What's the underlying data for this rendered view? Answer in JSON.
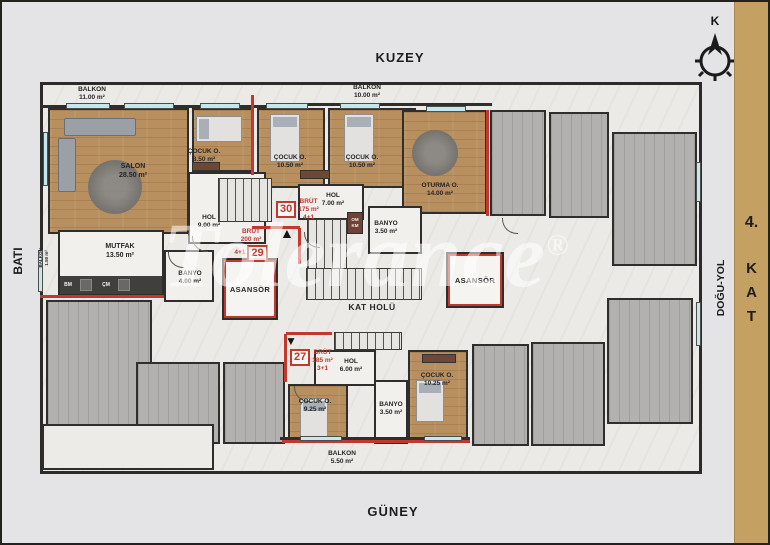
{
  "directions": {
    "north": "KUZEY",
    "south": "GÜNEY",
    "west": "BATI",
    "east": "DOĞU-YOL"
  },
  "compass": {
    "label": "K"
  },
  "floor": {
    "number": "4.",
    "letters": [
      "K",
      "A",
      "T"
    ]
  },
  "watermark": {
    "text": "Tolerance",
    "reg": "®"
  },
  "units": [
    {
      "number": "30",
      "brut": "BRÜT",
      "area": "175 m²",
      "type": "4+1"
    },
    {
      "number": "29",
      "brut": "BRÜT",
      "area": "200 m²",
      "type": "4+1"
    },
    {
      "number": "27",
      "brut": "BRÜT",
      "area": "185 m²",
      "type": "3+1"
    }
  ],
  "rooms": {
    "salon": {
      "name": "SALON",
      "area": "28.50 m²"
    },
    "cocuk_850": {
      "name": "ÇOCUK O.",
      "area": "8.50 m²"
    },
    "cocuk_1050a": {
      "name": "ÇOCUK O.",
      "area": "10.50 m²"
    },
    "cocuk_1050b": {
      "name": "ÇOCUK O.",
      "area": "10.50 m²"
    },
    "oturma": {
      "name": "OTURMA O.",
      "area": "14.00 m²"
    },
    "hol_900": {
      "name": "HOL",
      "area": "9.00 m²"
    },
    "hol_700": {
      "name": "HOL",
      "area": "7.00 m²"
    },
    "banyo_350_upper": {
      "name": "BANYO",
      "area": "3.50 m²"
    },
    "mutfak": {
      "name": "MUTFAK",
      "area": "13.50 m²"
    },
    "banyo_400": {
      "name": "BANYO",
      "area": "4.00 m²"
    },
    "asansor_left": {
      "name": "ASANSÖR"
    },
    "asansor_right": {
      "name": "ASANSÖR"
    },
    "kat_holu": {
      "name": "KAT HOLÜ"
    },
    "hol_600": {
      "name": "HOL",
      "area": "6.00 m²"
    },
    "cocuk_925": {
      "name": "ÇOCUK O.",
      "area": "9.25 m²"
    },
    "banyo_350_lower": {
      "name": "BANYO",
      "area": "3.50 m²"
    },
    "cocuk_1025": {
      "name": "ÇOCUK O.",
      "area": "10.25 m²"
    },
    "balkon_1100": {
      "name": "BALKON",
      "area": "11.00 m²"
    },
    "balkon_1000": {
      "name": "BALKON",
      "area": "10.00 m²"
    },
    "balkon_550": {
      "name": "BALKON",
      "area": "5.50 m²"
    },
    "balkon_150": {
      "name": "BALKON",
      "area": "1.50 m²"
    },
    "closet": {
      "top": "OM",
      "bottom": "KM"
    },
    "appliances": {
      "bm": "BM",
      "cm": "ÇM"
    }
  }
}
